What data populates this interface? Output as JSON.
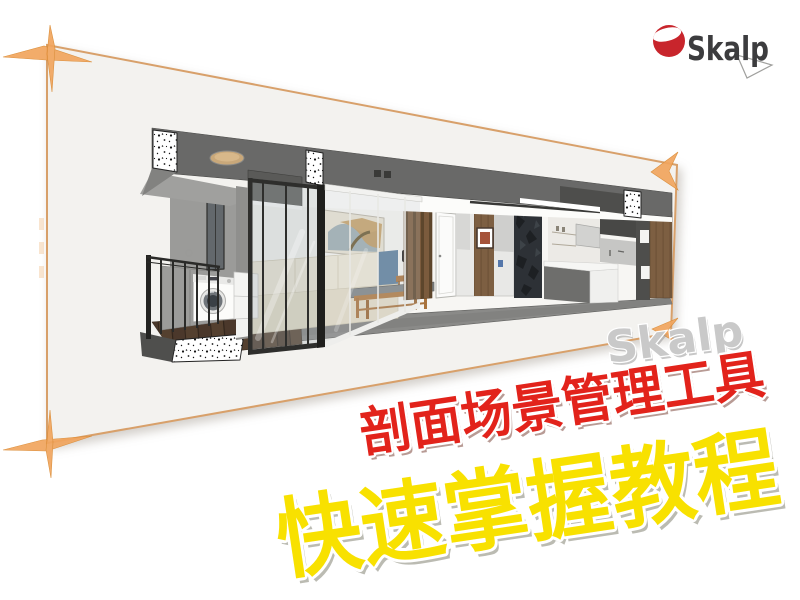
{
  "logo": {
    "text": "Skalp",
    "icon": "skalp-sphere-icon",
    "sphere_color": "#c8252c",
    "cut_color": "#ffffff",
    "text_color": "#3c3c3e"
  },
  "frame": {
    "panel_color": "#f3f2ef",
    "border_color": "#d8a06a",
    "marker_color": "#f1a55e"
  },
  "watermark": {
    "text": "Skalp",
    "color": "#c9c9c9",
    "outline": "#ffffff"
  },
  "titles": {
    "subtitle": {
      "text": "剖面场景管理工具",
      "color": "#e2231b",
      "outline": "#ffffff"
    },
    "main": {
      "text": "快速掌握教程",
      "color": "#f8e100",
      "outline": "#ffffff"
    }
  }
}
